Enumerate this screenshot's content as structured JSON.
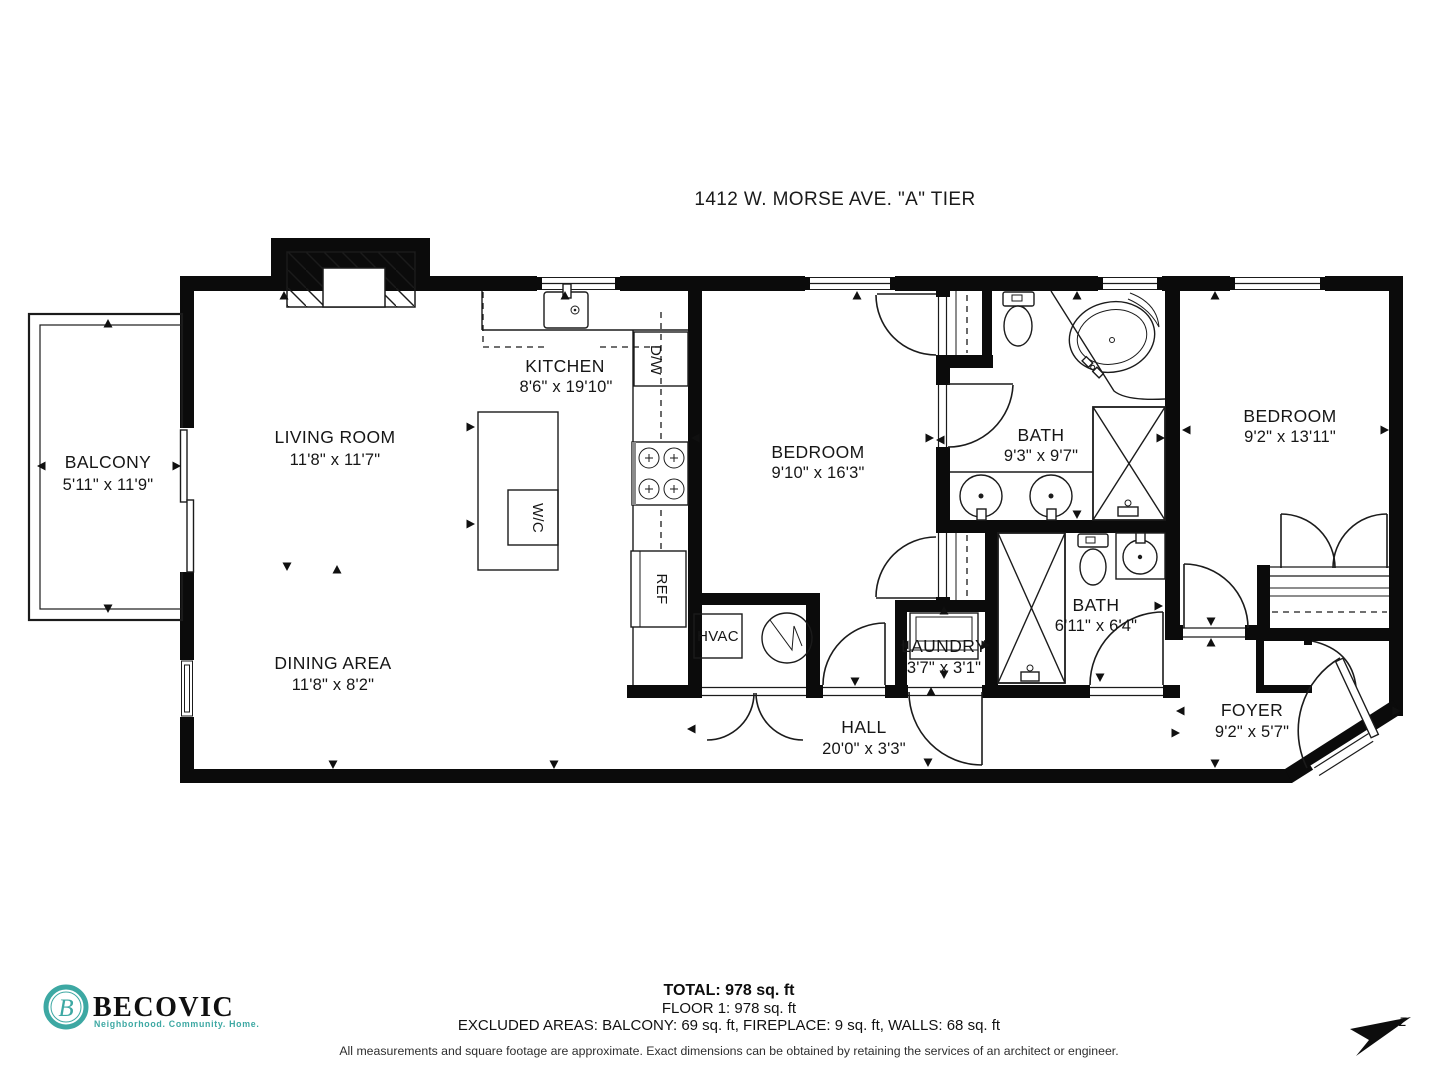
{
  "title": "1412 W. MORSE AVE. \"A\" TIER",
  "rooms": {
    "balcony": {
      "name": "BALCONY",
      "dims": "5'11\" x 11'9\""
    },
    "living_room": {
      "name": "LIVING ROOM",
      "dims": "11'8\" x 11'7\""
    },
    "kitchen": {
      "name": "KITCHEN",
      "dims": "8'6\" x 19'10\""
    },
    "dining_area": {
      "name": "DINING AREA",
      "dims": "11'8\" x 8'2\""
    },
    "bedroom1": {
      "name": "BEDROOM",
      "dims": "9'10\" x 16'3\""
    },
    "bath1": {
      "name": "BATH",
      "dims": "9'3\" x 9'7\""
    },
    "bedroom2": {
      "name": "BEDROOM",
      "dims": "9'2\" x 13'11\""
    },
    "bath2": {
      "name": "BATH",
      "dims": "6'11\" x 6'4\""
    },
    "laundry": {
      "name": "LAUNDRY",
      "dims": "3'7\" x 3'1\""
    },
    "hall": {
      "name": "HALL",
      "dims": "20'0\" x 3'3\""
    },
    "foyer": {
      "name": "FOYER",
      "dims": "9'2\" x 5'7\""
    }
  },
  "labels": {
    "hvac": "HVAC",
    "wc": "W/C",
    "dw": "D/W",
    "ref": "REF"
  },
  "summary": {
    "total": "TOTAL: 978 sq. ft",
    "floor": "FLOOR 1: 978 sq. ft",
    "excluded": "EXCLUDED AREAS: BALCONY: 69 sq. ft, FIREPLACE: 9 sq. ft, WALLS: 68 sq. ft",
    "disclaimer": "All measurements and square footage are approximate. Exact dimensions can be obtained by retaining the services of an architect or engineer."
  },
  "logo": {
    "brand": "BECOVIC",
    "monogram": "B",
    "tagline": "Neighborhood. Community. Home.",
    "teal": "#3DA8A3"
  },
  "compass": {
    "label": "z"
  }
}
